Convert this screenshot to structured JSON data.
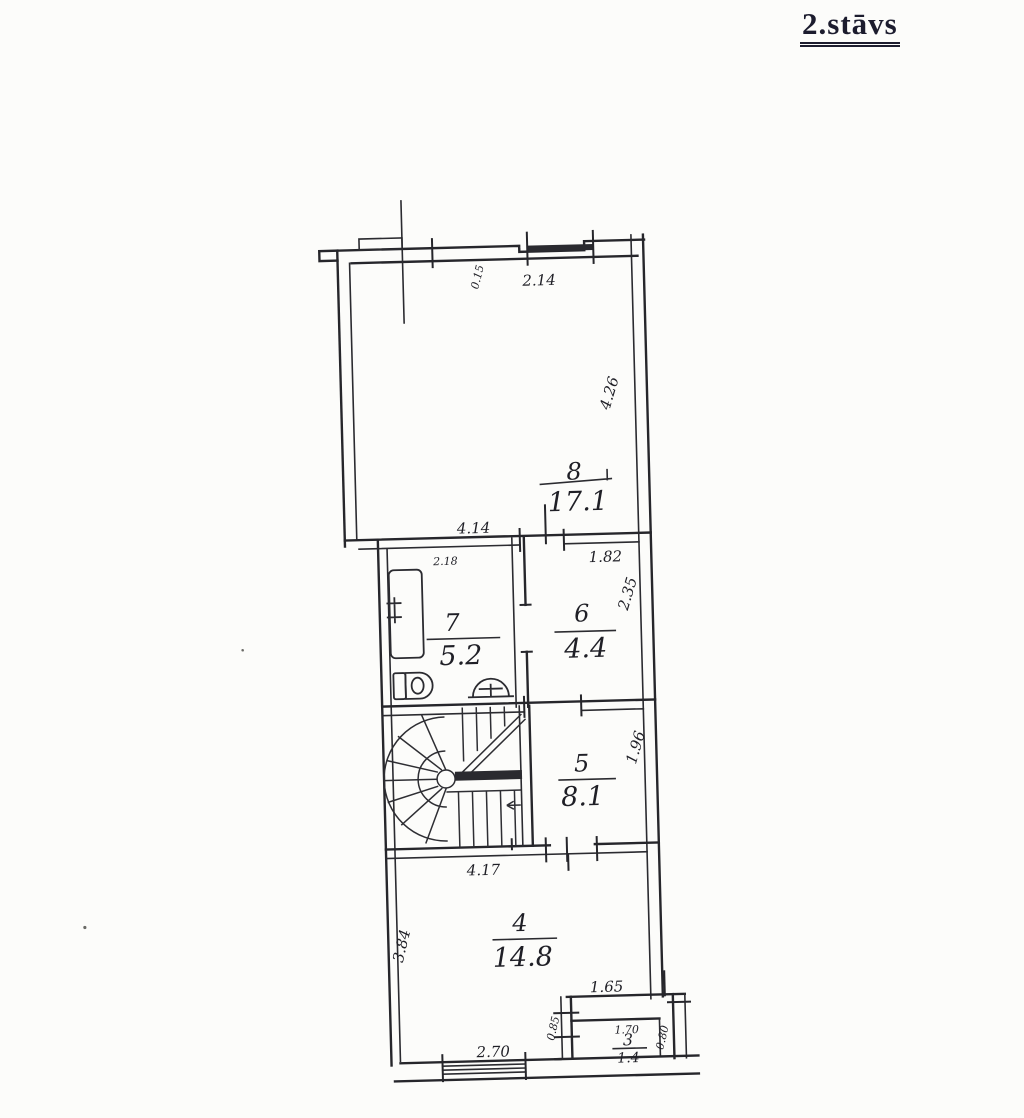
{
  "page": {
    "title": "2.stāvs"
  },
  "rooms": {
    "r8": {
      "number": "8",
      "area": "17.1"
    },
    "r7": {
      "number": "7",
      "area": "5.2"
    },
    "r6": {
      "number": "6",
      "area": "4.4"
    },
    "r5": {
      "number": "5",
      "area": "8.1"
    },
    "r4": {
      "number": "4",
      "area": "14.8"
    },
    "r3": {
      "number": "3",
      "area": "1.4"
    }
  },
  "dimensions": {
    "top_window": "2.14",
    "top_step": "0.15",
    "room8_width": "4.14",
    "room8_height": "4.26",
    "room7_width": "2.18",
    "room6_width": "1.82",
    "room6_height": "2.35",
    "room5_height": "1.96",
    "stair_wall_width": "4.17",
    "room4_height": "3.84",
    "room4_window": "2.70",
    "notch_width": "1.65",
    "notch_side": "0.85",
    "room3_width": "1.70",
    "room3_side": "0.80"
  }
}
